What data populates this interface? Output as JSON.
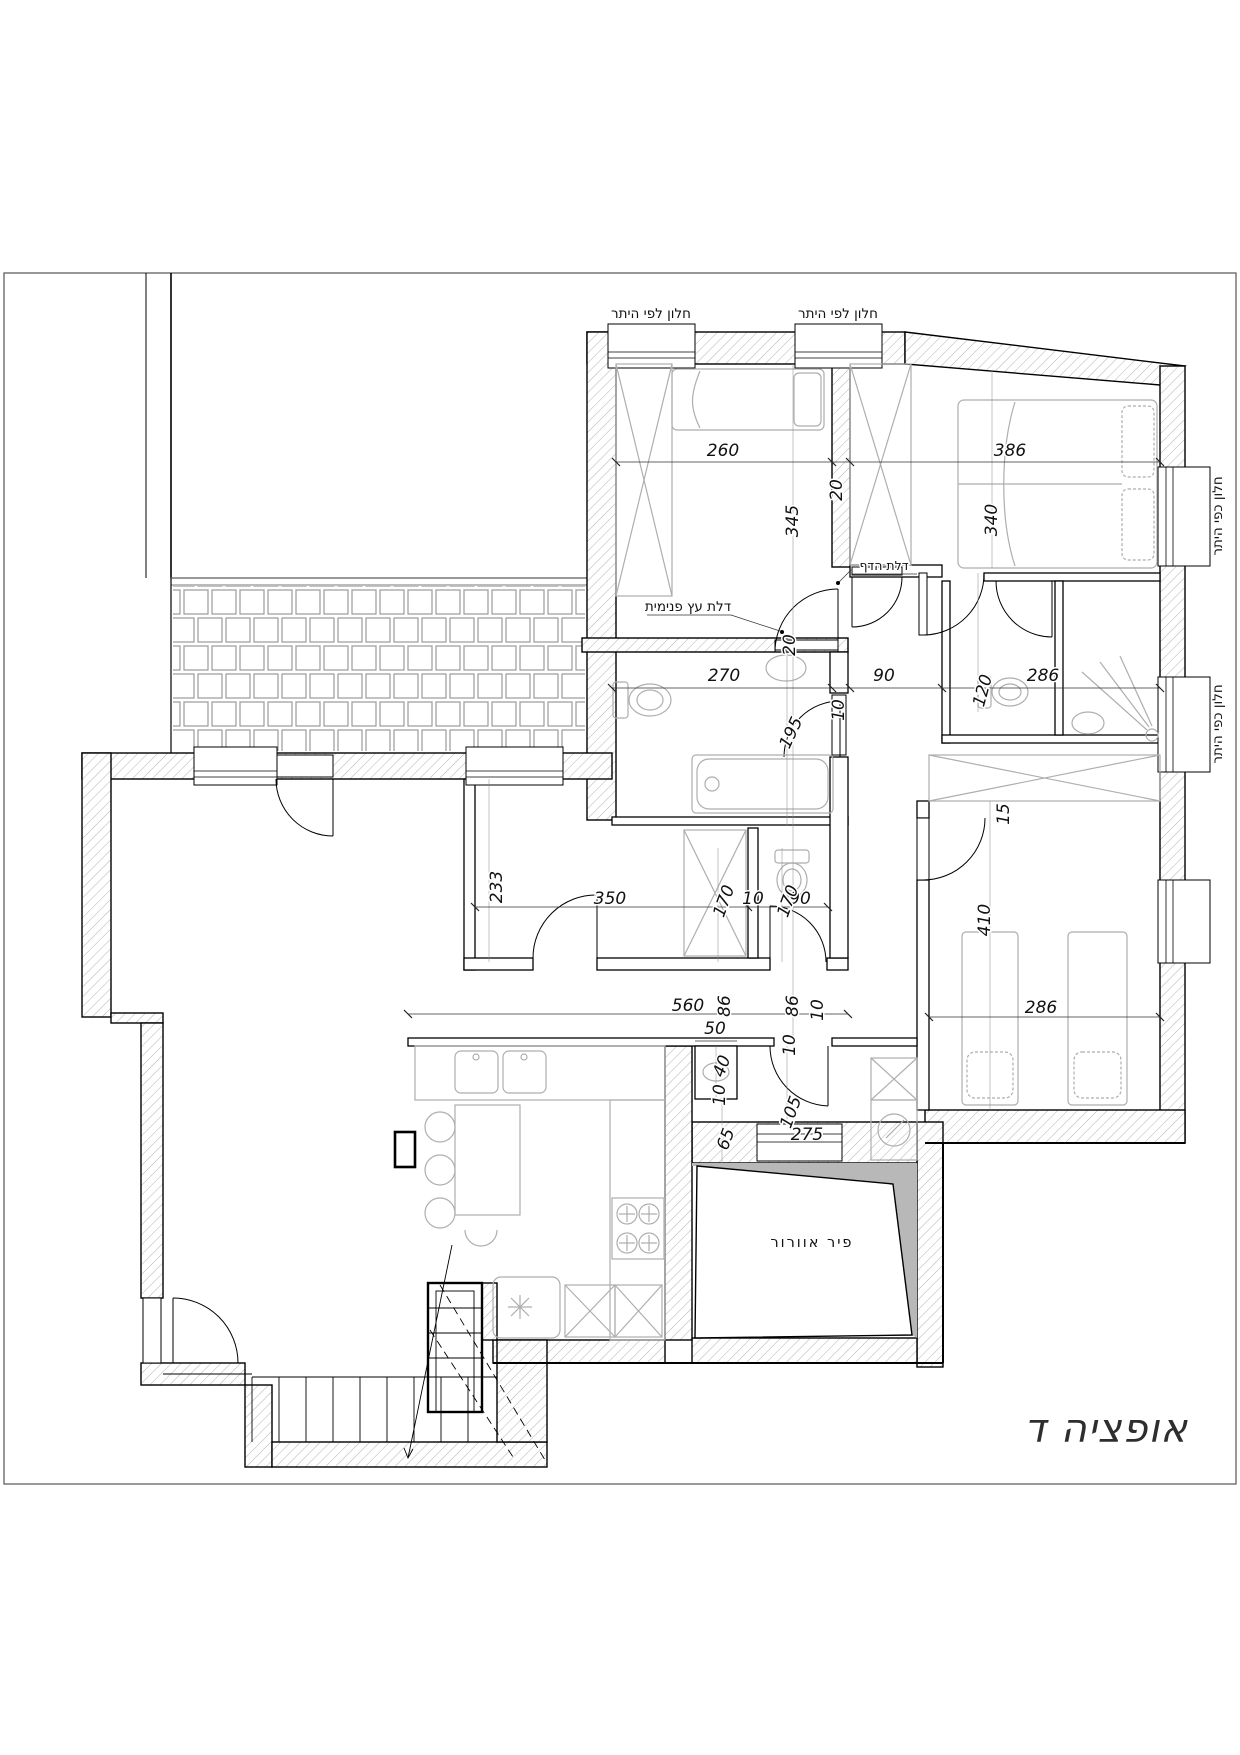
{
  "title": "אופציה ד",
  "labels": {
    "window_permit_top": "חלון לפי היתר",
    "window_permit_right": "חלון כפי היתר",
    "inner_wood_door": "דלת עץ פנימית",
    "blast_door": "דלת הדף",
    "vent_shaft": "פיר אוורור"
  },
  "dims": {
    "d10": "10",
    "d15": "15",
    "d20": "20",
    "d40": "40",
    "d50": "50",
    "d65": "65",
    "d86": "86",
    "d90": "90",
    "d105": "105",
    "d120": "120",
    "d170": "170",
    "d195": "195",
    "d233": "233",
    "d260": "260",
    "d270": "270",
    "d275": "275",
    "d286": "286",
    "d340": "340",
    "d345": "345",
    "d350": "350",
    "d386": "386",
    "d410": "410",
    "d560": "560"
  }
}
